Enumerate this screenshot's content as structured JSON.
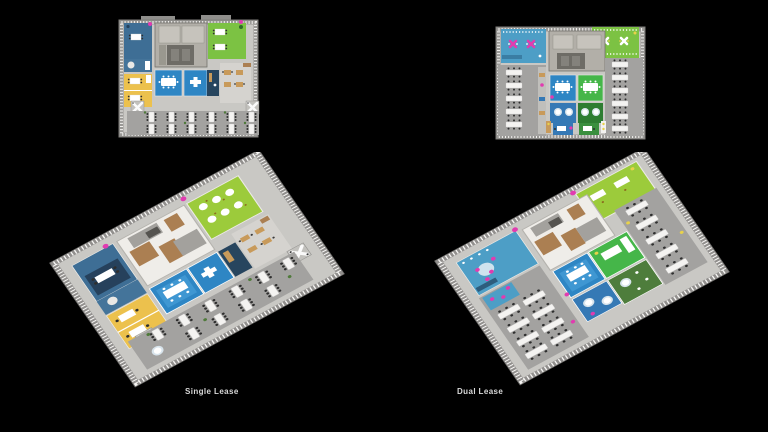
{
  "captions": {
    "single": "Single Lease",
    "dual": "Dual Lease"
  },
  "scene": {
    "background": "#000000",
    "views": [
      "single-lease-top-plan",
      "dual-lease-top-plan",
      "single-lease-iso-plan",
      "dual-lease-iso-plan"
    ]
  },
  "palette": {
    "floor_gray": "#c9c8c4",
    "walk_gray": "#a3a2a0",
    "core_gray": "#b2afa8",
    "core_dark": "#6e6c66",
    "wall_white": "#efede9",
    "steel_blue": "#3e6e95",
    "conference_blue": "#2e86c4",
    "teal_blue": "#4d9ec6",
    "navy": "#27455e",
    "lime_green": "#8cc63f",
    "green": "#45b649",
    "dark_green": "#2e7d32",
    "lawn_olive": "#4e7d3c",
    "yellow": "#ecc14d",
    "wood_tan": "#c89a5a",
    "wood_brown": "#ab7f52",
    "magenta": "#e13bb0",
    "accent_yellow": "#e8d24a",
    "white": "#ffffff"
  }
}
